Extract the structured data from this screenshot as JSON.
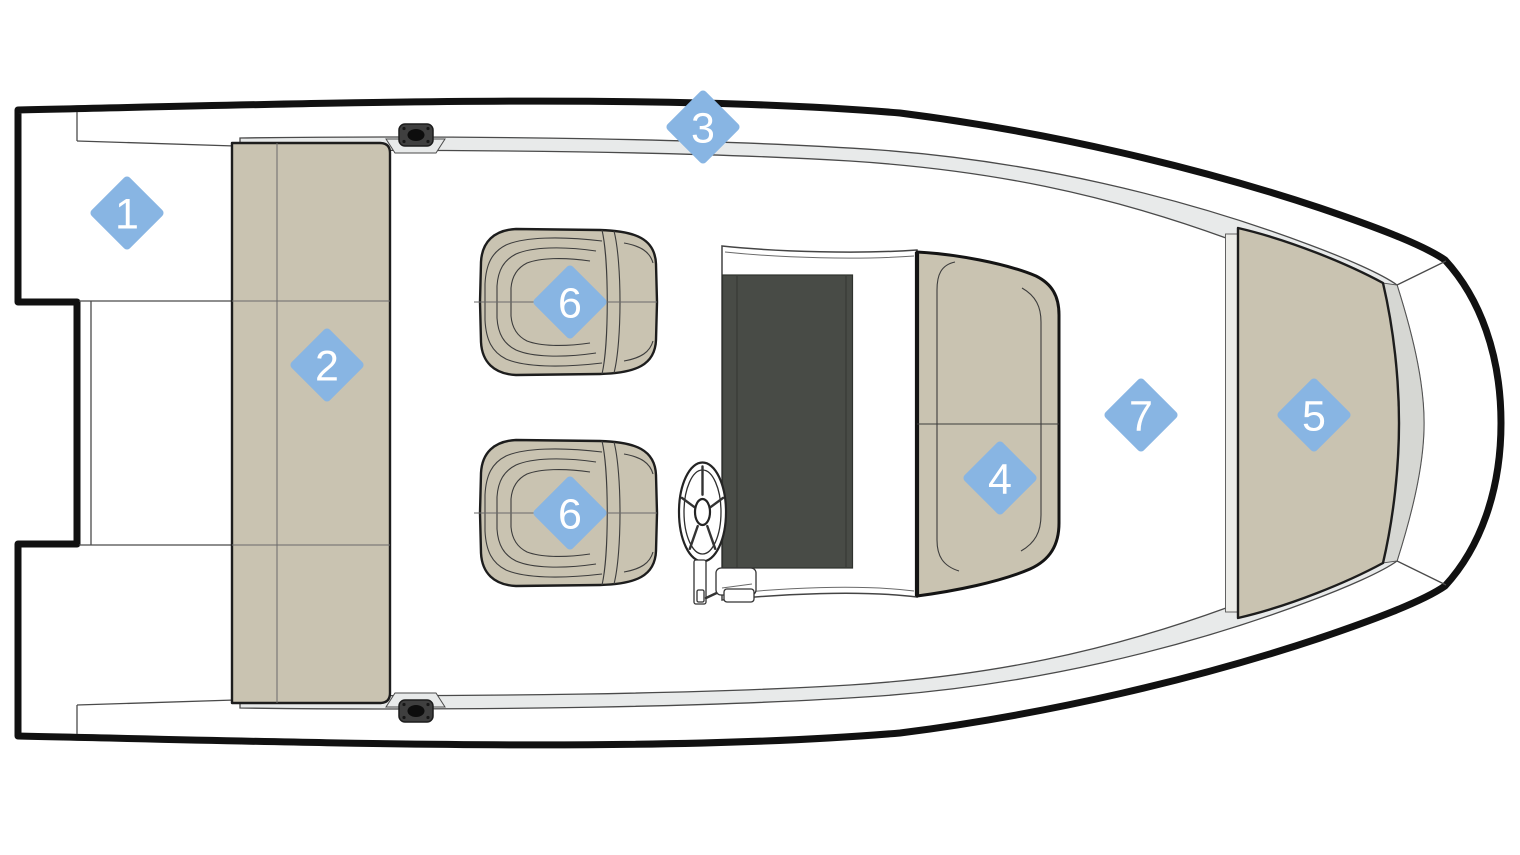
{
  "diagram": {
    "kind": "boat-deck-plan-top-view",
    "colors": {
      "accent": "#88b5e3",
      "marker_text": "#ffffff",
      "tan": "#c9c3b1",
      "band": "#e8eaea",
      "wedge": "#d6d7d3",
      "strip": "#ecece8",
      "console": "#484b46",
      "ink": "#111111",
      "line": "#4a4a4a"
    },
    "marker_style": {
      "shape": "diamond",
      "size": 54,
      "corner_radius": 4,
      "font_size": 43
    },
    "markers": [
      {
        "label": "1",
        "x": 127,
        "y": 213,
        "name": "stern-platform"
      },
      {
        "label": "2",
        "x": 327,
        "y": 365,
        "name": "aft-bench"
      },
      {
        "label": "3",
        "x": 703,
        "y": 127,
        "name": "gunwale"
      },
      {
        "label": "4",
        "x": 1000,
        "y": 478,
        "name": "console-seat"
      },
      {
        "label": "5",
        "x": 1314,
        "y": 415,
        "name": "bow-cushion"
      },
      {
        "label": "6",
        "x": 570,
        "y": 302,
        "name": "helm-chair-1"
      },
      {
        "label": "6",
        "x": 570,
        "y": 513,
        "name": "helm-chair-2"
      },
      {
        "label": "7",
        "x": 1141,
        "y": 415,
        "name": "cockpit-deck"
      }
    ]
  }
}
